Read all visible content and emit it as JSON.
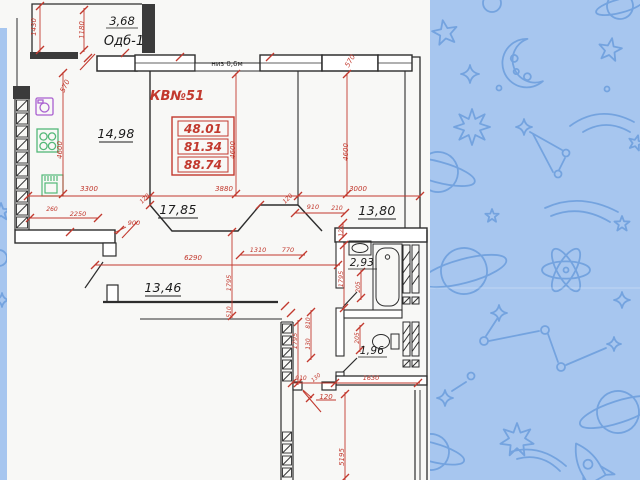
{
  "slide": {
    "background_theme": "space doodles on blue"
  },
  "colors": {
    "background": "#a7c6ef",
    "doodle": "#6fa0dd",
    "paper": "#f8f8f6",
    "wall": "#2d2d2d",
    "dimension_red": "#c2392e",
    "fixture_green": "#53b878",
    "fixture_purple": "#a95fd0"
  },
  "plan": {
    "apartment_label": "КВ№51",
    "balcony": {
      "area": "3,68",
      "name": "Одб-1"
    },
    "window_note": "низ 0,6м",
    "area_summary": [
      "48.01",
      "81.34",
      "88.74"
    ],
    "rooms": [
      {
        "id": "kitchen",
        "area": "14,98"
      },
      {
        "id": "living-room",
        "area": "17,85"
      },
      {
        "id": "bedroom",
        "area": "13,80"
      },
      {
        "id": "hallway",
        "area": "13,46"
      },
      {
        "id": "bathroom",
        "area": "2,93"
      },
      {
        "id": "wc",
        "area": "1,96"
      }
    ],
    "dimensions": [
      {
        "v": "1430",
        "x": 36,
        "y": 27,
        "r": -90
      },
      {
        "v": "1180",
        "x": 84,
        "y": 30,
        "r": -90
      },
      {
        "v": "570",
        "x": 67,
        "y": 87,
        "r": -65
      },
      {
        "v": "570",
        "x": 352,
        "y": 62,
        "r": -60
      },
      {
        "v": "4600",
        "x": 62,
        "y": 150,
        "r": -90
      },
      {
        "v": "4600",
        "x": 235,
        "y": 150,
        "r": -90
      },
      {
        "v": "4600",
        "x": 348,
        "y": 152,
        "r": -90
      },
      {
        "v": "3300",
        "x": 89,
        "y": 191,
        "r": 0
      },
      {
        "v": "3880",
        "x": 224,
        "y": 191,
        "r": 0
      },
      {
        "v": "3000",
        "x": 358,
        "y": 191,
        "r": 0
      },
      {
        "v": "120",
        "x": 146,
        "y": 200,
        "r": -45,
        "s": 6
      },
      {
        "v": "120",
        "x": 289,
        "y": 200,
        "r": -45,
        "s": 6
      },
      {
        "v": "260",
        "x": 52,
        "y": 211,
        "r": 0,
        "s": 6
      },
      {
        "v": "2250",
        "x": 78,
        "y": 216,
        "r": 0,
        "s": 6.5
      },
      {
        "v": "900",
        "x": 134,
        "y": 225,
        "r": 0,
        "s": 6.5
      },
      {
        "v": "910",
        "x": 313,
        "y": 209,
        "r": 0,
        "s": 6.5
      },
      {
        "v": "210",
        "x": 337,
        "y": 210,
        "r": 0,
        "s": 6
      },
      {
        "v": "120",
        "x": 343,
        "y": 231,
        "r": -90,
        "s": 6
      },
      {
        "v": "1310",
        "x": 258,
        "y": 252,
        "r": 0,
        "s": 6.5
      },
      {
        "v": "770",
        "x": 288,
        "y": 252,
        "r": 0,
        "s": 6.5
      },
      {
        "v": "6290",
        "x": 193,
        "y": 260,
        "r": 0
      },
      {
        "v": "1795",
        "x": 231,
        "y": 283,
        "r": -90,
        "s": 6.5
      },
      {
        "v": "1795",
        "x": 343,
        "y": 279,
        "r": -90,
        "s": 6.5
      },
      {
        "v": "1795",
        "x": 297,
        "y": 341,
        "r": -90,
        "s": 6.5
      },
      {
        "v": "510",
        "x": 231,
        "y": 312,
        "r": -90,
        "s": 6
      },
      {
        "v": "810",
        "x": 310,
        "y": 323,
        "r": -90,
        "s": 6
      },
      {
        "v": "130",
        "x": 310,
        "y": 344,
        "r": -90,
        "s": 6
      },
      {
        "v": "205",
        "x": 360,
        "y": 287,
        "r": -90,
        "s": 6
      },
      {
        "v": "205",
        "x": 359,
        "y": 338,
        "r": -90,
        "s": 6
      },
      {
        "v": "910",
        "x": 301,
        "y": 380,
        "r": 0,
        "s": 6
      },
      {
        "v": "130",
        "x": 317,
        "y": 379,
        "r": -40,
        "s": 5.5
      },
      {
        "v": "1630",
        "x": 371,
        "y": 380,
        "r": 0,
        "s": 6.5
      },
      {
        "v": "120",
        "x": 326,
        "y": 399,
        "r": 0,
        "s": 7
      },
      {
        "v": "5195",
        "x": 344,
        "y": 457,
        "r": -90
      }
    ]
  },
  "background_icons": [
    "crescent-moon",
    "five-point-star",
    "sparkle-star",
    "burst-star",
    "saturn-planet",
    "atom",
    "comet",
    "constellation",
    "rocket",
    "ring"
  ]
}
